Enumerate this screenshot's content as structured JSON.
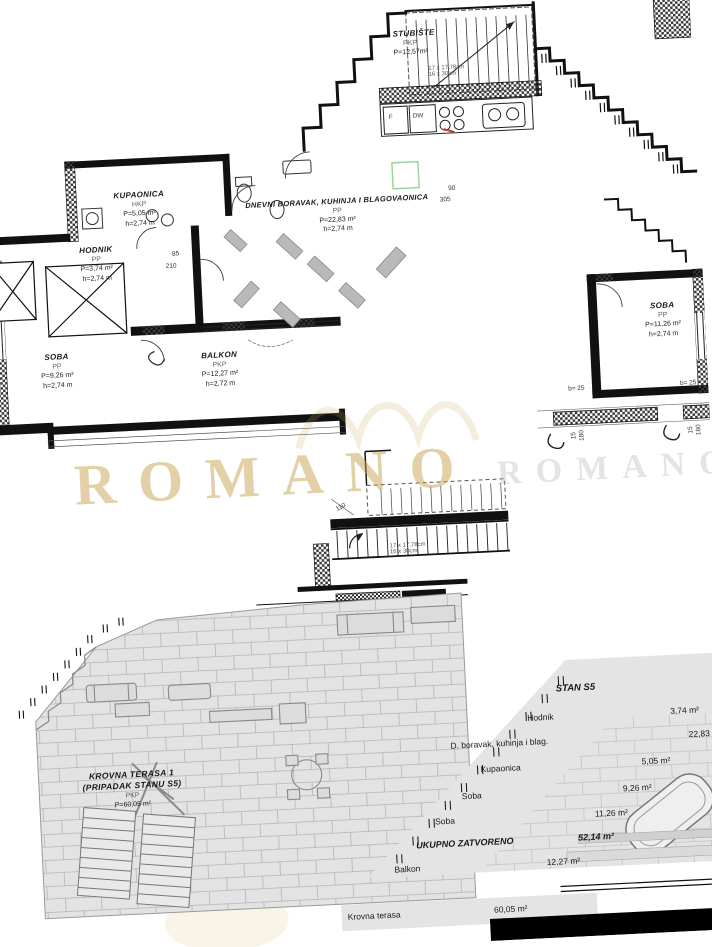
{
  "watermark": {
    "text": "ROMANO",
    "ghost_text": "ROMANO",
    "gold": "#c59d48"
  },
  "rooms": {
    "stubiste": {
      "name": "STUBIŠTE",
      "type": "PKP",
      "area": "P=12,57m²"
    },
    "kupaonica": {
      "name": "KUPAONICA",
      "type": "HKP",
      "area": "P=5,05 m²",
      "height": "h=2,74 m"
    },
    "hodnik": {
      "name": "HODNIK",
      "type": "PP",
      "area": "P=3,74 m²",
      "height": "h=2,74 m"
    },
    "dnevni": {
      "name": "DNEVNI BORAVAK, KUHINJA I BLAGOVAONICA",
      "type": "PP",
      "area": "P=22,83 m²",
      "height": "h=2,74 m"
    },
    "soba_left": {
      "name": "SOBA",
      "type": "PP",
      "area": "P=9,26 m²",
      "height": "h=2,74 m"
    },
    "balkon": {
      "name": "BALKON",
      "type": "PKP",
      "area": "P=12,27 m²",
      "height": "h=2,72 m"
    },
    "soba_right": {
      "name": "SOBA",
      "type": "PP",
      "area": "P=11,26 m²",
      "height": "h=2,74 m"
    },
    "krovna": {
      "name": "KROVNA TERASA 1",
      "subname": "(PRIPADAK STANU S5)",
      "type": "PKP",
      "area": "P=60,05 m²"
    }
  },
  "appliances": {
    "fridge": "F",
    "dishwasher": "DW"
  },
  "stair_note": {
    "line1": "17 x 17,78cm",
    "line2": "16 x 30cm"
  },
  "dims": {
    "d90": "90",
    "d305": "305",
    "d85": "85",
    "d210": "210",
    "d110": "110",
    "b25": "b= 25",
    "v180": "180",
    "v15": "15"
  },
  "table": {
    "title": "STAN S5",
    "rows": [
      {
        "label": "Hodnik",
        "value": "3,74 m²"
      },
      {
        "label": "D. boravak, kuhinja i blag.",
        "value": "22,83 m²"
      },
      {
        "label": "Kupaonica",
        "value": "5,05 m²"
      },
      {
        "label": "Soba",
        "value": "9,26 m²"
      },
      {
        "label": "Soba",
        "value": "11,26 m²"
      }
    ],
    "total": {
      "label": "UKUPNO ZATVORENO",
      "value": "52,14 m²"
    },
    "balkon": {
      "label": "Balkon",
      "value": "12,27 m²"
    },
    "terasa": {
      "label": "Krovna terasa",
      "value": "60,05 m²"
    }
  }
}
